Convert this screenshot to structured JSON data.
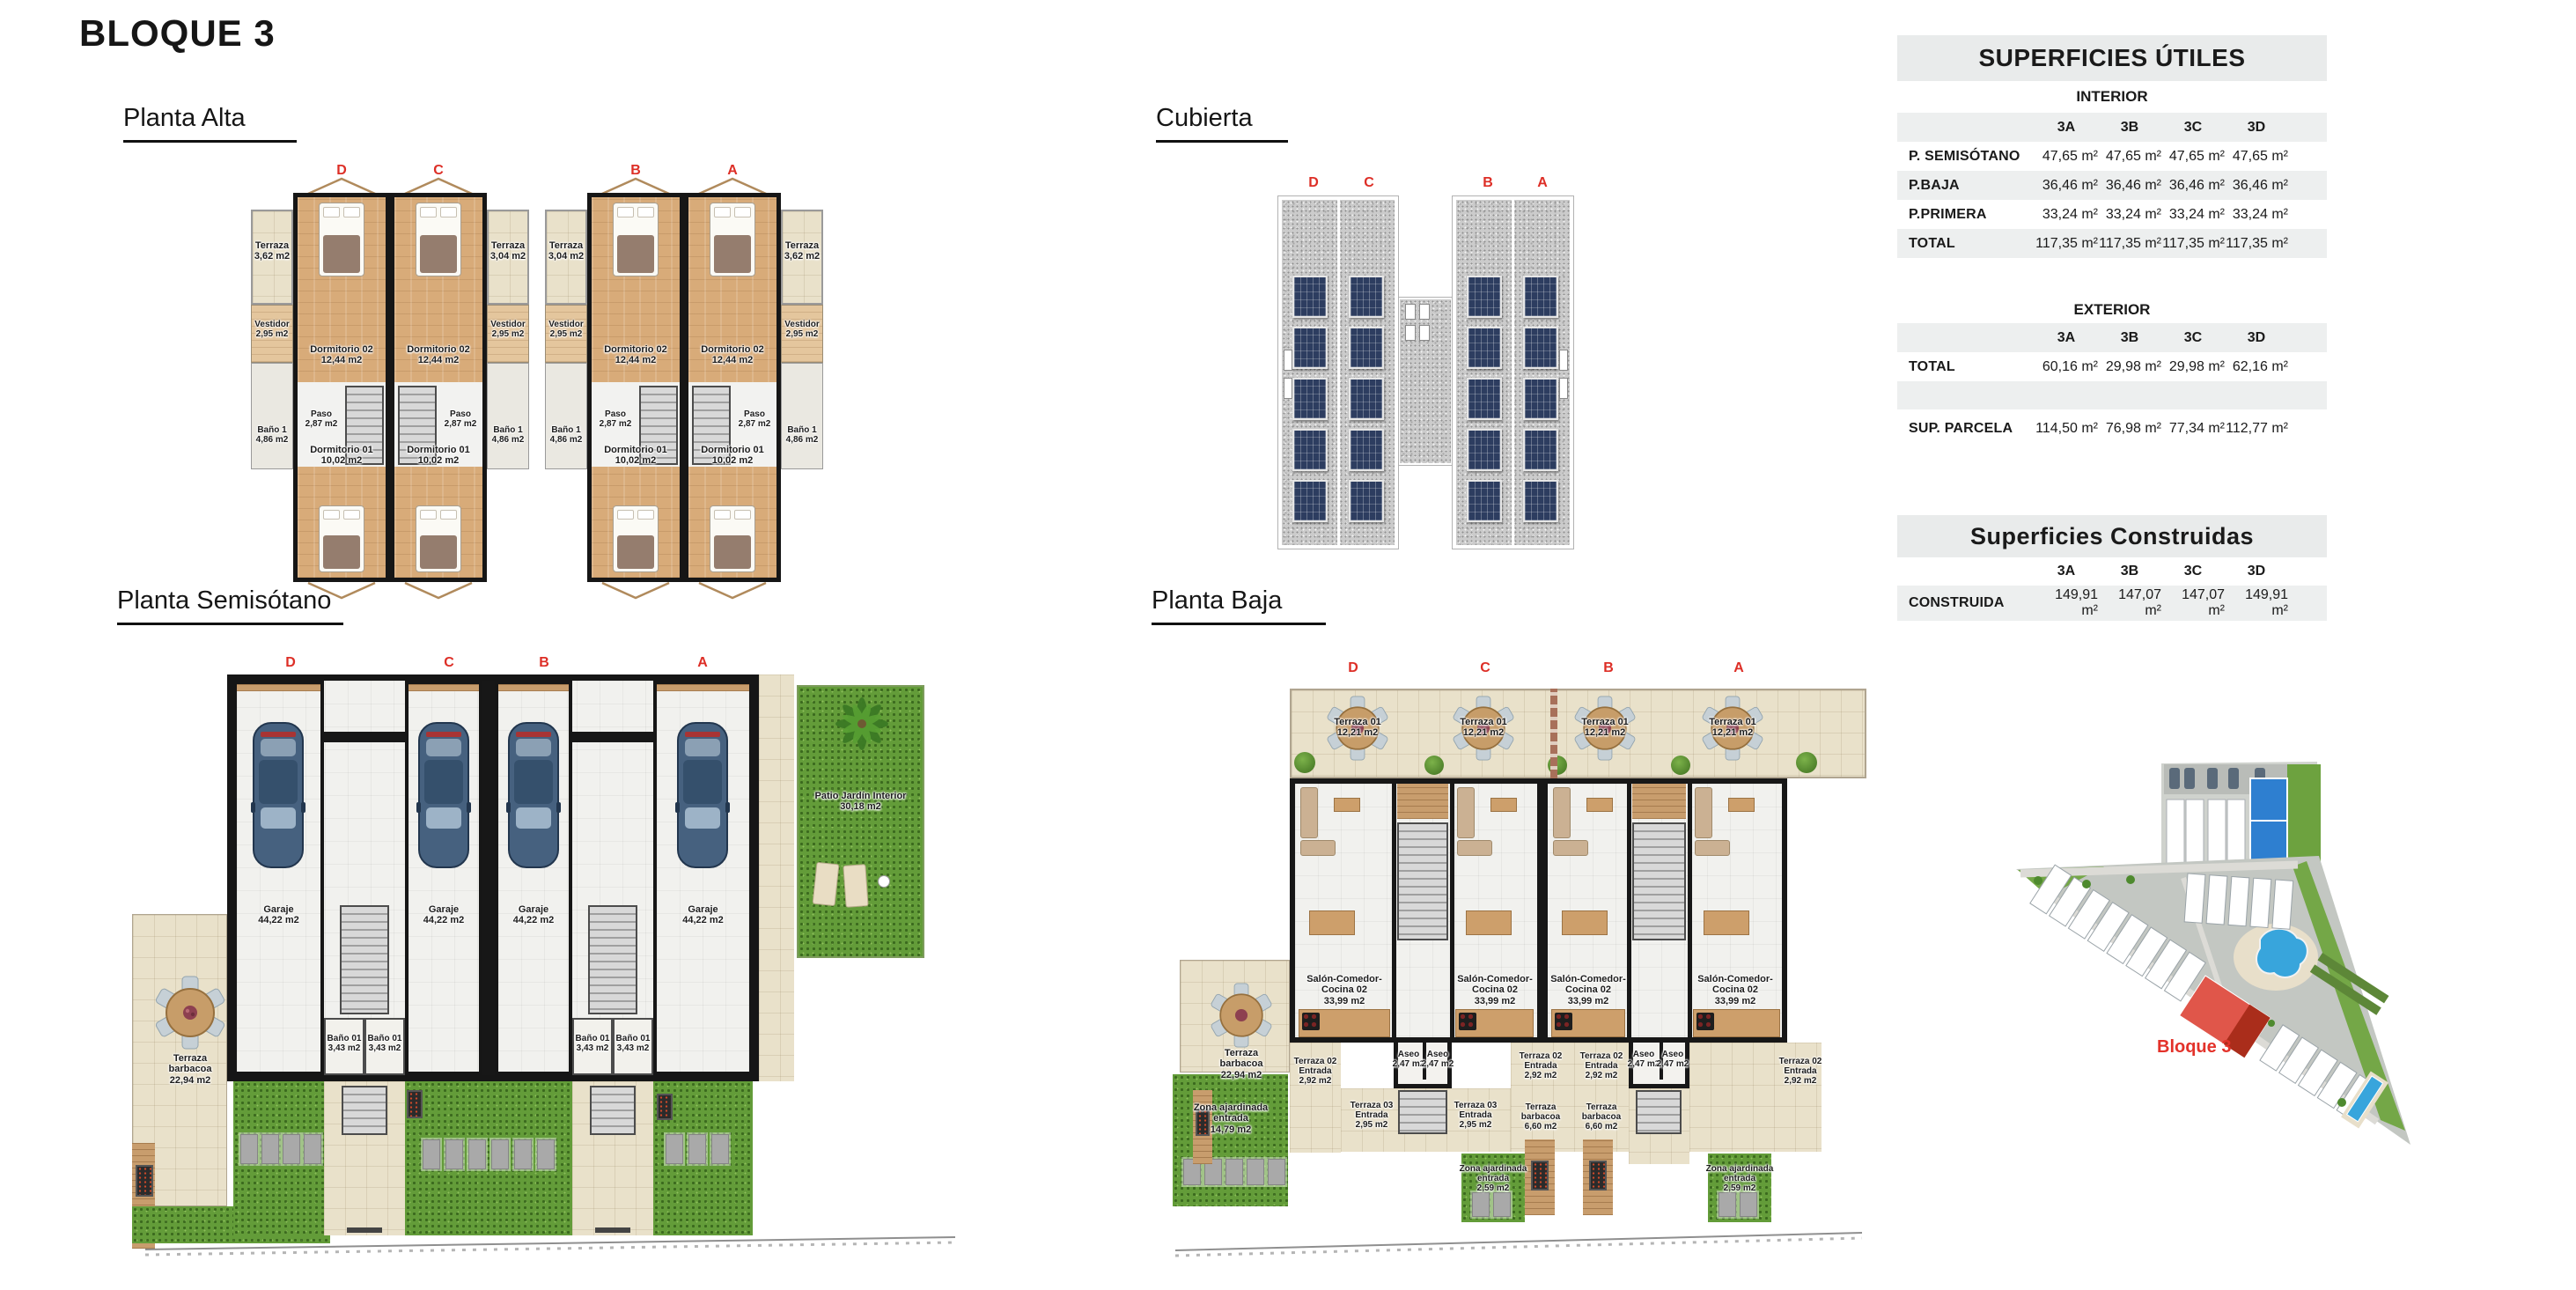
{
  "page": {
    "title": "BLOQUE 3"
  },
  "units": [
    "D",
    "C",
    "B",
    "A"
  ],
  "alta": {
    "title": "Planta Alta",
    "rooms": {
      "terraza_ext": {
        "l1": "Terraza",
        "l2": "3,62 m2"
      },
      "terraza_int": {
        "l1": "Terraza",
        "l2": "3,04 m2"
      },
      "dorm02": {
        "l1": "Dormitorio 02",
        "l2": "12,44 m2"
      },
      "vestidor": {
        "l1": "Vestidor",
        "l2": "2,95 m2"
      },
      "paso": {
        "l1": "Paso",
        "l2": "2,87 m2"
      },
      "bano": {
        "l1": "Baño 1",
        "l2": "4,86 m2"
      },
      "dorm01": {
        "l1": "Dormitorio 01",
        "l2": "10,02 m2"
      }
    }
  },
  "cubierta": {
    "title": "Cubierta"
  },
  "semi": {
    "title": "Planta Semisótano",
    "rooms": {
      "garaje": {
        "l1": "Garaje",
        "l2": "44,22 m2"
      },
      "bano": {
        "l1": "Baño 01",
        "l2": "3,43 m2"
      },
      "terraza": {
        "l1": "Terraza",
        "l2": "barbacoa",
        "l3": "22,94 m2"
      },
      "patio": {
        "l1": "Patio Jardín Interior",
        "l2": "30,18 m2"
      }
    }
  },
  "baja": {
    "title": "Planta Baja",
    "rooms": {
      "terraza01": {
        "l1": "Terraza 01",
        "l2": "12,21 m2"
      },
      "salon": {
        "l1": "Salón-Comedor-",
        "l2": "Cocina 02",
        "l3": "33,99 m2"
      },
      "aseo": {
        "l1": "Aseo",
        "l2": "2,47 m2"
      },
      "t02": {
        "l1": "Terraza 02",
        "l2": "Entrada",
        "l3": "2,92 m2"
      },
      "t03": {
        "l1": "Terraza 03",
        "l2": "Entrada",
        "l3": "2,95 m2"
      },
      "barb6": {
        "l1": "Terraza",
        "l2": "barbacoa",
        "l3": "6,60 m2"
      },
      "barb22": {
        "l1": "Terraza",
        "l2": "barbacoa",
        "l3": "22,94 m2"
      },
      "zona14": {
        "l1": "Zona ajardinada",
        "l2": "entrada",
        "l3": "14,79 m2"
      },
      "zona259": {
        "l1": "Zona ajardinada",
        "l2": "entrada",
        "l3": "2,59 m2"
      }
    }
  },
  "utiles": {
    "title": "SUPERFICIES ÚTILES",
    "cols": [
      "3A",
      "3B",
      "3C",
      "3D"
    ],
    "interior": {
      "name": "INTERIOR",
      "rows": [
        {
          "label": "P. SEMISÓTANO",
          "v": [
            "47,65 m²",
            "47,65 m²",
            "47,65 m²",
            "47,65 m²"
          ]
        },
        {
          "label": "P.BAJA",
          "v": [
            "36,46 m²",
            "36,46 m²",
            "36,46 m²",
            "36,46 m²"
          ]
        },
        {
          "label": "P.PRIMERA",
          "v": [
            "33,24 m²",
            "33,24 m²",
            "33,24 m²",
            "33,24 m²"
          ]
        },
        {
          "label": "TOTAL",
          "v": [
            "117,35 m²",
            "117,35 m²",
            "117,35 m²",
            "117,35 m²"
          ]
        }
      ]
    },
    "exterior": {
      "name": "EXTERIOR",
      "rows": [
        {
          "label": "TOTAL",
          "v": [
            "60,16 m²",
            "29,98 m²",
            "29,98 m²",
            "62,16 m²"
          ]
        },
        {
          "label": "SUP. PARCELA",
          "v": [
            "114,50 m²",
            "76,98 m²",
            "77,34 m²",
            "112,77 m²"
          ]
        }
      ]
    }
  },
  "construidas": {
    "title": "Superficies Construidas",
    "cols": [
      "3A",
      "3B",
      "3C",
      "3D"
    ],
    "rows": [
      {
        "label": "CONSTRUIDA",
        "v": [
          "149,91 m²",
          "147,07 m²",
          "147,07 m²",
          "149,91 m²"
        ]
      }
    ]
  },
  "site": {
    "label": "Bloque 3"
  }
}
